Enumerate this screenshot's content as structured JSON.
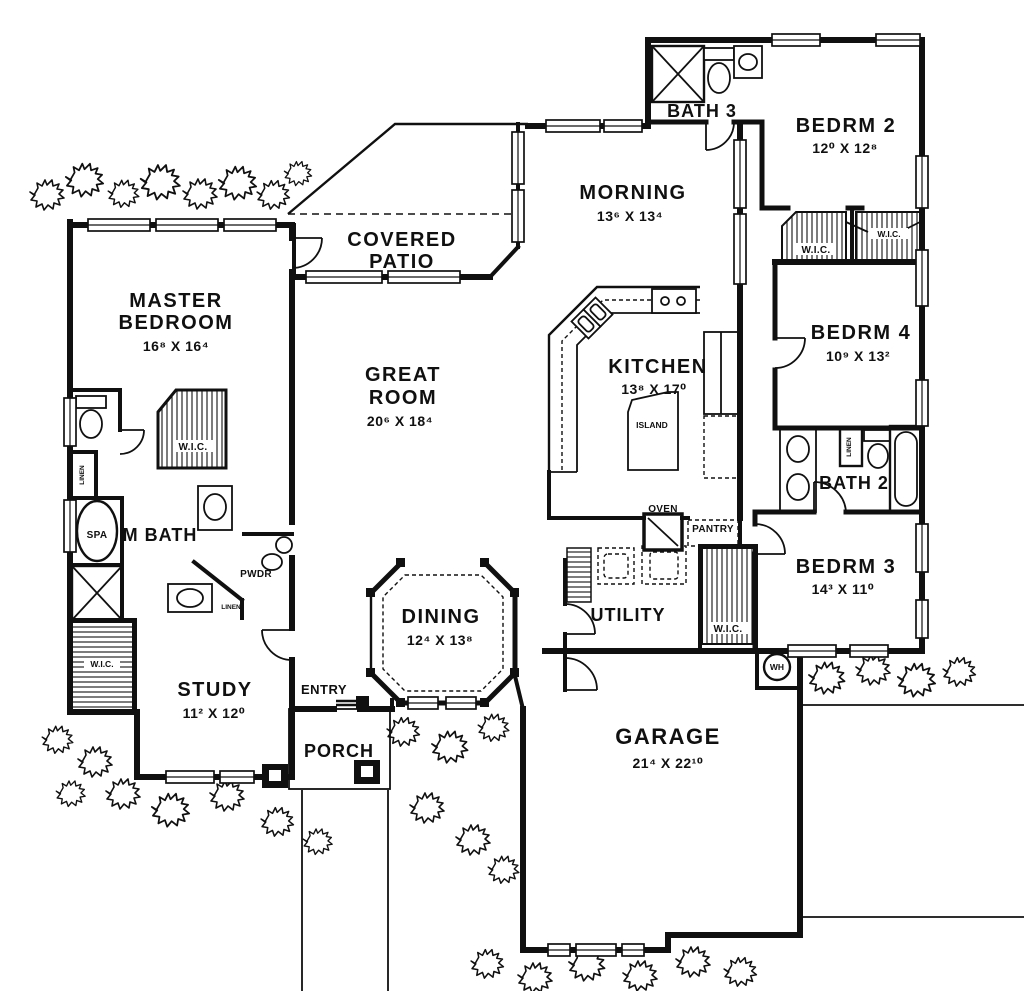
{
  "plan": {
    "rooms": {
      "bath3": {
        "name": "BATH 3"
      },
      "bedrm2": {
        "name": "BEDRM 2",
        "dims": "12⁰ X 12⁸"
      },
      "morning": {
        "name": "MORNING",
        "dims": "13⁶ X 13⁴"
      },
      "covered_patio": {
        "line1": "COVERED",
        "line2": "PATIO"
      },
      "master_bedroom": {
        "line1": "MASTER",
        "line2": "BEDROOM",
        "dims": "16⁸ X 16⁴"
      },
      "great_room": {
        "line1": "GREAT",
        "line2": "ROOM",
        "dims": "20⁶ X 18⁴"
      },
      "kitchen": {
        "name": "KITCHEN",
        "dims": "13⁸ X 17⁰"
      },
      "bedrm4": {
        "name": "BEDRM 4",
        "dims": "10⁹ X 13²"
      },
      "bath2": {
        "name": "BATH 2"
      },
      "bedrm3": {
        "name": "BEDRM 3",
        "dims": "14³ X 11⁰"
      },
      "m_bath": {
        "name": "M BATH"
      },
      "study": {
        "name": "STUDY",
        "dims": "11² X 12⁰"
      },
      "dining": {
        "name": "DINING",
        "dims": "12⁴ X 13⁸"
      },
      "utility": {
        "name": "UTILITY"
      },
      "entry": {
        "name": "ENTRY"
      },
      "porch": {
        "name": "PORCH"
      },
      "garage": {
        "name": "GARAGE",
        "dims": "21⁴ X 22¹⁰"
      }
    },
    "features": {
      "wic": "W.I.C.",
      "linen": "LINEN",
      "pwdr": "PWDR",
      "spa": "SPA",
      "island": "ISLAND",
      "oven": "OVEN",
      "pantry": "PANTRY",
      "wh": "WH"
    },
    "colors": {
      "ink": "#101010",
      "paper": "#ffffff"
    }
  }
}
